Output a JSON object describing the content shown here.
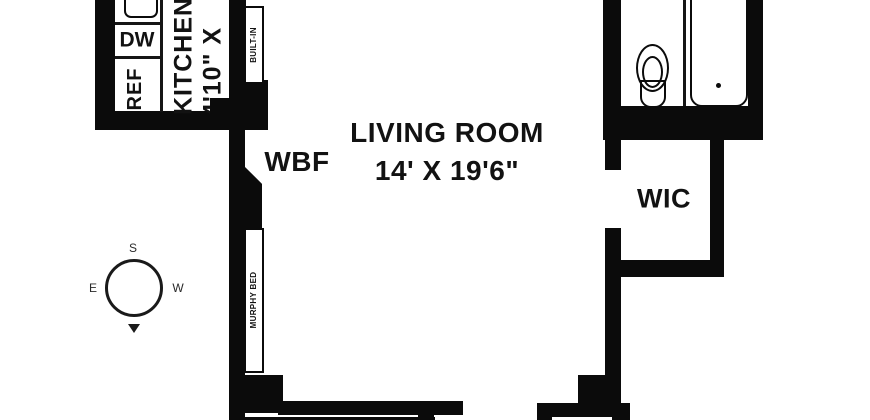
{
  "document_type": "apartment floor plan",
  "labels": {
    "living_room": {
      "name": "LIVING ROOM",
      "dims": "14' X 19'6\""
    },
    "kitchen": {
      "name": "KITCHEN",
      "dims": "4'10\" X"
    },
    "wic": "WIC",
    "wbf": "WBF",
    "dw": "DW",
    "ref": "REF",
    "built_in": "BUILT-IN",
    "murphy_bed": "MURPHY BED"
  },
  "compass": {
    "top": "S",
    "left": "E",
    "right": "W",
    "arrow": "down-triangle"
  },
  "fixtures": [
    "kitchen-sink",
    "dishwasher",
    "refrigerator",
    "toilet",
    "bathtub",
    "murphy-bed",
    "built-in-cabinet",
    "wood-burning-fireplace"
  ],
  "colors": {
    "wall": "#0b0b0b",
    "background": "#ffffff",
    "text": "#121212"
  }
}
